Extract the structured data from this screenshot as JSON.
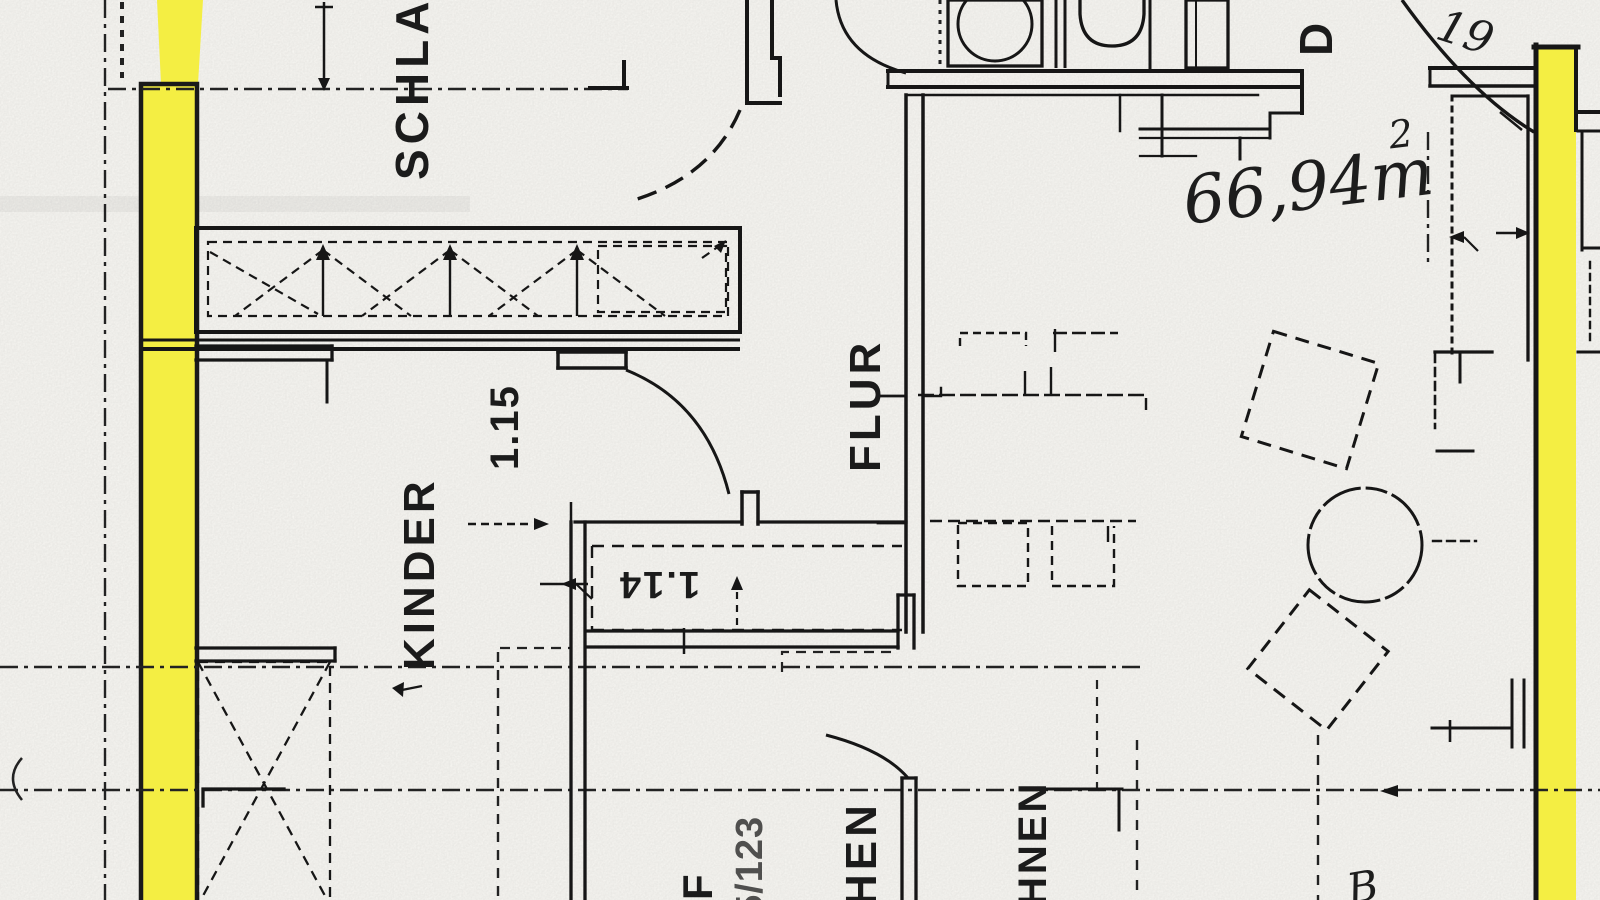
{
  "colors": {
    "highlight": "#f4ee43",
    "paper": "#fdfcf8",
    "ink": "#1a1a1a"
  },
  "room_labels": {
    "schlafen_fragment": "SCHLAF",
    "flur": "FLUR",
    "kinder": "KINDER",
    "kochen_fragment": "HEN",
    "wohnen_fragment": "HNEN",
    "bad_fragment": "D"
  },
  "dimensions": {
    "schlaf_door_width": "1.15",
    "niche_width": "1.14"
  },
  "handwritten": {
    "area_value": "66,94m",
    "area_exponent": "2",
    "corner_note": "19",
    "bottom_note": "B"
  },
  "reference_labels": {
    "f_fragment": "F",
    "number_fragment": "5/123"
  }
}
